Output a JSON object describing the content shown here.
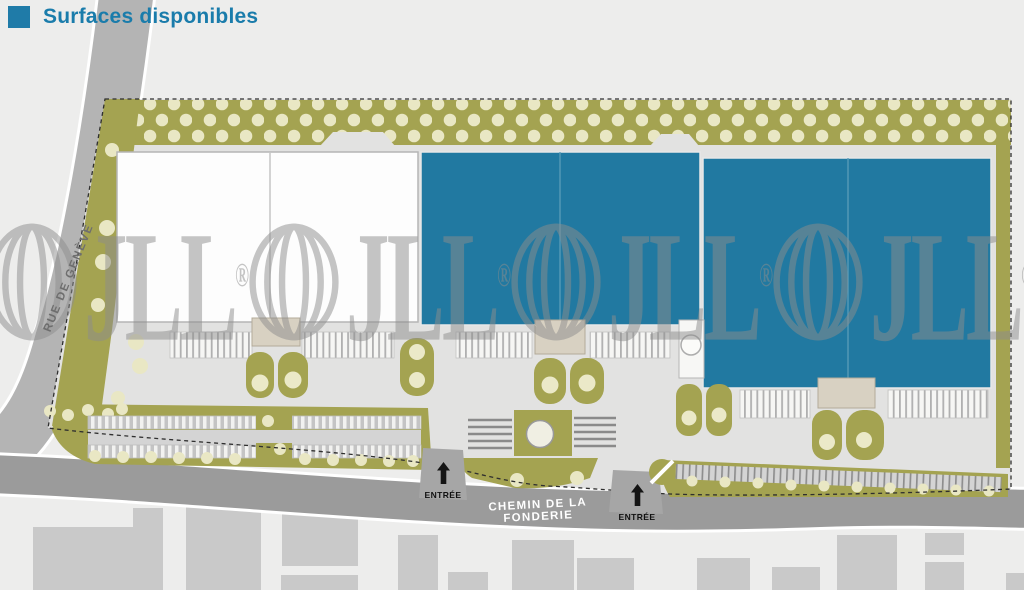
{
  "legend": {
    "label": "Surfaces disponibles"
  },
  "colors": {
    "available": "#2179a1",
    "unavailable": "#fdfdfd",
    "legend_blue": "#1f7ba8",
    "landscape": "#a4a351",
    "tree": "#e9e7c4",
    "road_main": "#9b9b9b",
    "road_side": "#b4b4b4",
    "watermark": "#8d8d8d"
  },
  "site": {
    "streets": [
      {
        "name": "RUE DE GENÈVE"
      },
      {
        "name": "CHEMIN DE LA FONDERIE"
      }
    ],
    "entrances": [
      {
        "label": "ENTRÉE"
      },
      {
        "label": "ENTRÉE"
      }
    ],
    "buildings": [
      {
        "id": "building-1",
        "status": "not-available",
        "units": 2
      },
      {
        "id": "building-2",
        "status": "available",
        "units": 2
      },
      {
        "id": "building-3",
        "status": "available",
        "units": 2
      }
    ]
  },
  "watermark": {
    "text": "JLL",
    "registered": "®"
  }
}
